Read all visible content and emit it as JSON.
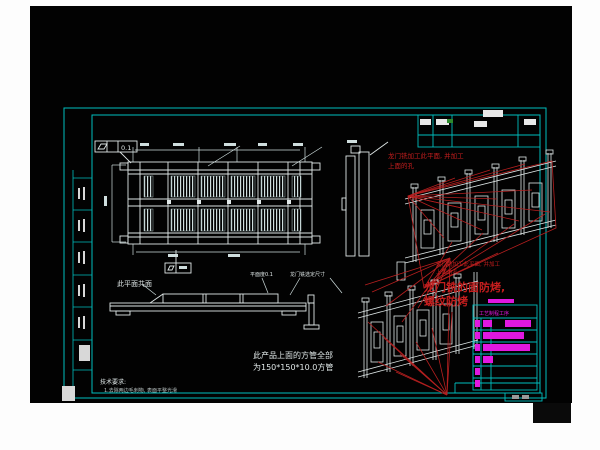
{
  "colors": {
    "photo_bg": "#020202",
    "margin": "#fdfdfd",
    "frame": "#00bdbd",
    "line": "#dfe7e7",
    "dim": "#cfdede",
    "red": "#b51f1f",
    "red_text": "#c41e1e",
    "magenta": "#e018e0",
    "white_block": "#e9e9e9",
    "gray_text": "#9a9a9a",
    "green_mark": "#2d8a2d"
  },
  "annotations": {
    "iso_note_line1": "龙门铣加工此平面, 并加工",
    "iso_note_line2": "上面的孔",
    "big_note_line1": "龙门铣的面防烤,",
    "big_note_line2": "螺纹防烤",
    "coplanar": "此平面共面",
    "flatness_note": "平面度0.1",
    "mill_size": "龙门铣选定尺寸",
    "tube_line1": "此产品上面的方管全部",
    "tube_line2": "为150*150*10.0方管",
    "tech_title": "技术要求:",
    "tech_item": "1.去除两边毛刺物, 表面平整光滑",
    "gdt_value": "0.1"
  },
  "process_table": {
    "header": "工艺制程工序",
    "bars": [
      [
        [
          475,
          5
        ],
        [
          483,
          9
        ],
        [
          505,
          26
        ]
      ],
      [
        [
          475,
          5
        ],
        [
          483,
          41
        ]
      ],
      [
        [
          475,
          5
        ],
        [
          483,
          47
        ]
      ],
      [
        [
          475,
          5
        ],
        [
          483,
          10
        ]
      ],
      [
        [
          475,
          5
        ]
      ],
      [
        [
          475,
          5
        ]
      ]
    ]
  }
}
